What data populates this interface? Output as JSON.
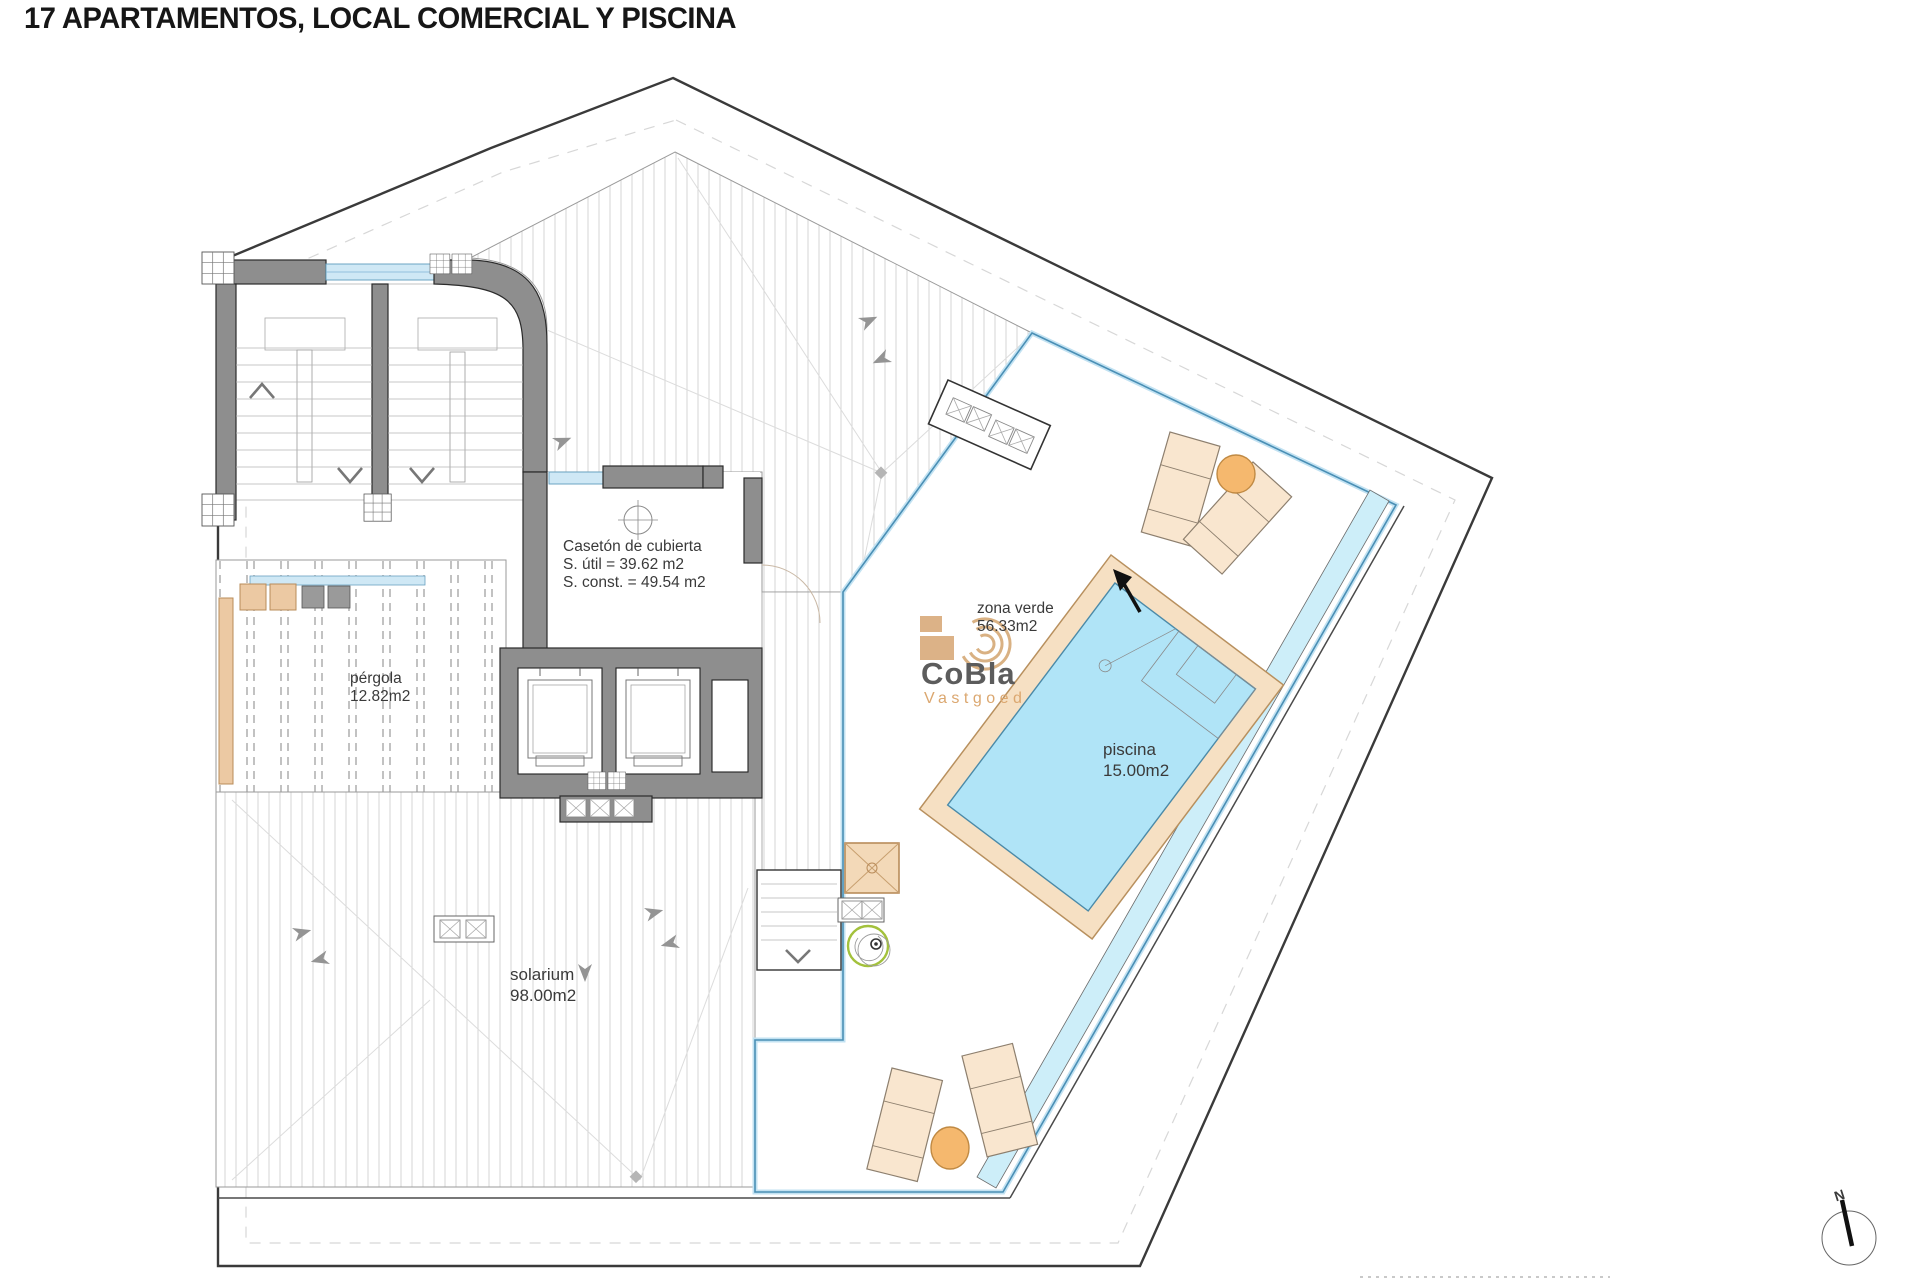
{
  "page": {
    "title": "17 APARTAMENTOS, LOCAL COMERCIAL Y PISCINA"
  },
  "annotations": {
    "caseton": [
      "Casetón de cubierta",
      "S. útil = 39.62 m2",
      "S. const. = 49.54 m2"
    ],
    "zona_verde": [
      "zona verde",
      "56.33m2"
    ],
    "piscina": [
      "piscina",
      "15.00m2"
    ],
    "pergola": [
      "pérgola",
      "12.82m2"
    ],
    "solarium": [
      "solarium",
      "98.00m2"
    ]
  },
  "watermark": {
    "brand": "CoBla",
    "subtitle": "Vastgoed"
  },
  "compass": {
    "north_label": "N"
  },
  "colors": {
    "wall_gray": "#8e8e8e",
    "boundary": "#3a3a3a",
    "glass_blue": "#4a8fb5",
    "glass_light": "#c2e2f2",
    "water_blue": "#b0e4f7",
    "channel_cyan": "#cdeef9",
    "coping_tan": "#f6e0c3",
    "furniture_tan": "#f9e6cf",
    "umbrella_orange": "#f5b86e",
    "logo_tan": "#dcb287",
    "plant_green": "#a3c13c",
    "glazing_fill": "#cfe8f5"
  }
}
